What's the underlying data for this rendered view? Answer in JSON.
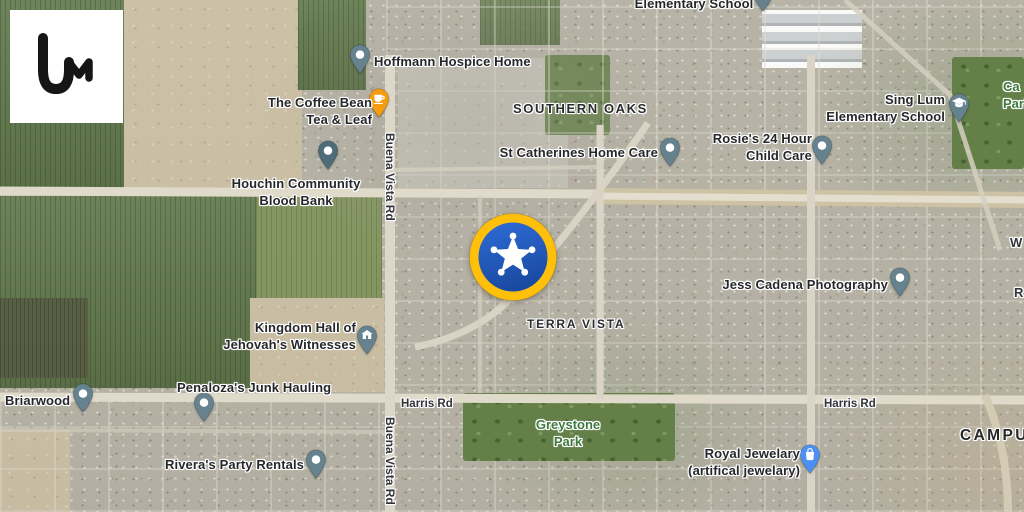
{
  "app": {
    "brand": "liveuamap",
    "logo_glyph": "Um",
    "logo_bg": "#ffffff",
    "logo_fg": "#161616"
  },
  "event_badge": {
    "icon": "sheriff-star-badge",
    "x": 513,
    "y": 257,
    "ring_color": "#FFC00C",
    "inner_top": "#2E6CD6",
    "inner_bottom": "#1A4BA3",
    "star_color": "#FFFFFF"
  },
  "map": {
    "view": "satellite",
    "area_labels": [
      {
        "id": "southern-oaks",
        "text": "SOUTHERN OAKS",
        "x": 513,
        "y": 101,
        "size": 13,
        "ls": 1.6
      },
      {
        "id": "terra-vista",
        "text": "TERRA VISTA",
        "x": 527,
        "y": 317,
        "size": 12,
        "ls": 1.8
      },
      {
        "id": "campus",
        "text": "CAMPUS",
        "x": 960,
        "y": 427,
        "size": 15.5,
        "ls": 2.4,
        "color": "#26272b"
      }
    ],
    "green_labels": [
      {
        "id": "campus-park",
        "lines": [
          "Ca",
          "Park"
        ],
        "anchor": "left",
        "ax": 1003,
        "y": 78
      },
      {
        "id": "greystone-park",
        "lines": [
          "Greystone",
          "Park"
        ],
        "anchor": "center",
        "ax": 568,
        "y": 416
      }
    ],
    "road_labels": [
      {
        "id": "harris-rd-west",
        "text": "Harris Rd",
        "x": 401,
        "y": 398
      },
      {
        "id": "harris-rd-east",
        "text": "Harris Rd",
        "x": 824,
        "y": 398
      },
      {
        "id": "buena-vista-rd-north",
        "text": "Buena Vista Rd",
        "x": 397,
        "y": 133,
        "rotate": 90,
        "size": 12
      },
      {
        "id": "buena-vista-rd-south",
        "text": "Buena Vista Rd",
        "x": 397,
        "y": 417,
        "rotate": 90,
        "size": 12
      },
      {
        "id": "w-road-partial",
        "text": "W",
        "x": 1010,
        "y": 235,
        "size": 13
      },
      {
        "id": "r-road-partial",
        "text": "R",
        "x": 1014,
        "y": 285,
        "size": 13
      }
    ],
    "pois": [
      {
        "id": "elementary-school-north",
        "lines": [
          "Elementary School"
        ],
        "anchor": "center",
        "ax": 694,
        "y": -5,
        "pin": {
          "x": 763,
          "y": 12,
          "color": "#66828F",
          "icon": "dot"
        }
      },
      {
        "id": "hoffmann-hospice-home",
        "lines": [
          "Hoffmann Hospice Home"
        ],
        "anchor": "left",
        "ax": 374,
        "y": 53,
        "pin": {
          "x": 360,
          "y": 74,
          "color": "#66828F",
          "icon": "dot"
        }
      },
      {
        "id": "coffee-bean-tea-leaf",
        "lines": [
          "The Coffee Bean",
          "Tea & Leaf"
        ],
        "anchor": "right",
        "ax": 372,
        "y": 94,
        "pin": {
          "x": 379,
          "y": 118,
          "color": "#F59D0E",
          "icon": "coffee"
        }
      },
      {
        "id": "st-catherines-home-care",
        "lines": [
          "St Catherines Home Care"
        ],
        "anchor": "right",
        "ax": 658,
        "y": 144,
        "pin": {
          "x": 670,
          "y": 167,
          "color": "#66828F",
          "icon": "dot"
        }
      },
      {
        "id": "rosies-24-hour-child-care",
        "lines": [
          "Rosie's 24 Hour",
          "Child Care"
        ],
        "anchor": "right",
        "ax": 812,
        "y": 130,
        "pin": {
          "x": 822,
          "y": 165,
          "color": "#66828F",
          "icon": "dot"
        }
      },
      {
        "id": "sing-lum-elementary",
        "lines": [
          "Sing Lum",
          "Elementary School"
        ],
        "anchor": "right",
        "ax": 945,
        "y": 91,
        "pin": {
          "x": 959,
          "y": 123,
          "color": "#66828F",
          "icon": "grad-cap"
        }
      },
      {
        "id": "houchin-blood-bank",
        "lines": [
          "Houchin Community",
          "Blood Bank"
        ],
        "anchor": "center",
        "ax": 296,
        "y": 175,
        "pin": {
          "x": 328,
          "y": 170,
          "color": "#4E6B7A",
          "icon": "dot"
        }
      },
      {
        "id": "jess-cadena-photography",
        "lines": [
          "Jess Cadena Photography"
        ],
        "anchor": "right",
        "ax": 888,
        "y": 276,
        "pin": {
          "x": 900,
          "y": 297,
          "color": "#66828F",
          "icon": "dot"
        }
      },
      {
        "id": "kingdom-hall",
        "lines": [
          "Kingdom Hall of",
          "Jehovah's Witnesses"
        ],
        "anchor": "right",
        "ax": 356,
        "y": 319,
        "pin": {
          "x": 367,
          "y": 355,
          "color": "#66828F",
          "icon": "building"
        }
      },
      {
        "id": "briarwood",
        "lines": [
          "Briarwood"
        ],
        "anchor": "left",
        "ax": 5,
        "y": 392,
        "pin": {
          "x": 83,
          "y": 413,
          "color": "#66828F",
          "icon": "dot"
        }
      },
      {
        "id": "penalozas-junk-hauling",
        "lines": [
          "Penaloza's Junk Hauling"
        ],
        "anchor": "left",
        "ax": 177,
        "y": 379,
        "pin": {
          "x": 204,
          "y": 422,
          "color": "#66828F",
          "icon": "dot"
        }
      },
      {
        "id": "riveras-party-rentals",
        "lines": [
          "Rivera's Party Rentals"
        ],
        "anchor": "right",
        "ax": 304,
        "y": 456,
        "pin": {
          "x": 316,
          "y": 479,
          "color": "#66828F",
          "icon": "dot"
        }
      },
      {
        "id": "royal-jewelary",
        "lines": [
          "Royal Jewelary",
          "(artifical jewelary)"
        ],
        "anchor": "right",
        "ax": 800,
        "y": 445,
        "pin": {
          "x": 810,
          "y": 474,
          "color": "#4D8FF2",
          "icon": "bag"
        }
      }
    ]
  }
}
